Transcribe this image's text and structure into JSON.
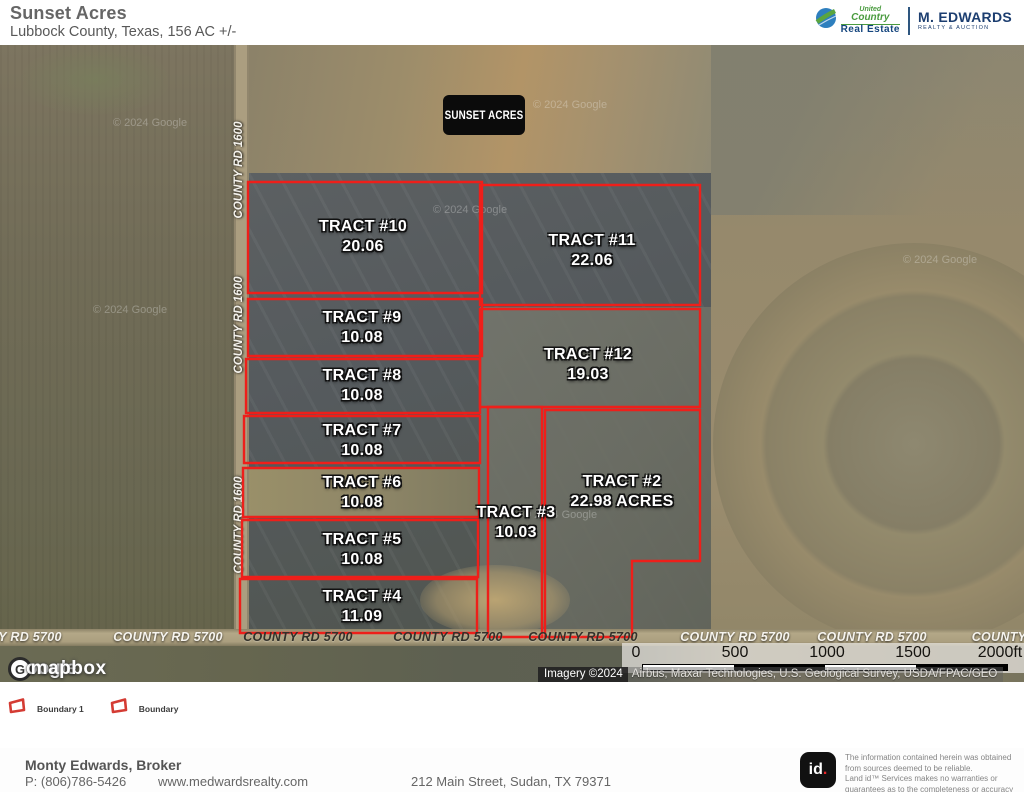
{
  "header": {
    "title": "Sunset Acres",
    "subtitle": "Lubbock County, Texas, 156 AC +/-",
    "brand": {
      "uc_top": "United",
      "uc_mid": "Country",
      "uc_bottom": "Real Estate",
      "agency_name": "M. EDWARDS",
      "agency_tagline": "REALTY & AUCTION"
    }
  },
  "map": {
    "badge": "SUNSET ACRES",
    "boundary_color": "#ee1f1a",
    "tracts": [
      {
        "id": "tract-10",
        "name": "TRACT #10",
        "acres": "20.06",
        "points": "248,137 482,137 482,248 248,248",
        "label": {
          "x": 363,
          "y": 192
        }
      },
      {
        "id": "tract-11",
        "name": "TRACT #11",
        "acres": "22.06",
        "points": "480,140 700,140 700,260 480,260",
        "label": {
          "x": 592,
          "y": 206
        }
      },
      {
        "id": "tract-9",
        "name": "TRACT #9",
        "acres": "10.08",
        "points": "248,254 482,254 482,311 248,311",
        "label": {
          "x": 362,
          "y": 283
        }
      },
      {
        "id": "tract-12",
        "name": "TRACT #12",
        "acres": "19.03",
        "points": "480,264 700,264 700,362 480,362",
        "label": {
          "x": 588,
          "y": 320
        }
      },
      {
        "id": "tract-8",
        "name": "TRACT #8",
        "acres": "10.08",
        "points": "246,314 480,314 480,368 246,368",
        "label": {
          "x": 362,
          "y": 341
        }
      },
      {
        "id": "tract-7",
        "name": "TRACT #7",
        "acres": "10.08",
        "points": "244,371 480,371 480,418 244,418",
        "label": {
          "x": 362,
          "y": 396
        }
      },
      {
        "id": "tract-6",
        "name": "TRACT #6",
        "acres": "10.08",
        "points": "243,423 479,423 479,472 243,472",
        "label": {
          "x": 362,
          "y": 448
        }
      },
      {
        "id": "tract-5",
        "name": "TRACT #5",
        "acres": "10.08",
        "points": "242,475 478,475 478,532 242,532",
        "label": {
          "x": 362,
          "y": 505
        }
      },
      {
        "id": "tract-4",
        "name": "TRACT #4",
        "acres": "11.09",
        "points": "240,534 477,534 477,588 240,588",
        "label": {
          "x": 362,
          "y": 562
        }
      },
      {
        "id": "tract-3",
        "name": "TRACT #3",
        "acres": "10.03",
        "points": "488,362 542,362 542,592 488,592",
        "label": {
          "x": 516,
          "y": 478
        }
      },
      {
        "id": "tract-2",
        "name": "TRACT #2",
        "acres": "22.98 ACRES",
        "points": "545,365 700,365 700,516 632,516 632,592 545,592",
        "label": {
          "x": 622,
          "y": 447
        }
      }
    ],
    "road_labels_vertical": [
      {
        "text": "COUNTY RD 1600",
        "x": 239,
        "y": 125
      },
      {
        "text": "COUNTY RD 1600",
        "x": 239,
        "y": 280
      },
      {
        "text": "COUNTY RD 1600",
        "x": 239,
        "y": 480
      }
    ],
    "road_labels_horizontal": [
      {
        "text": "Y RD 5700",
        "x": 30,
        "y": 592,
        "tone": "light"
      },
      {
        "text": "COUNTY RD 5700",
        "x": 168,
        "y": 592,
        "tone": "light"
      },
      {
        "text": "COUNTY RD 5700",
        "x": 298,
        "y": 592,
        "tone": "dark"
      },
      {
        "text": "COUNTY RD 5700",
        "x": 448,
        "y": 592,
        "tone": "dark"
      },
      {
        "text": "COUNTY RD 5700",
        "x": 583,
        "y": 592,
        "tone": "dark"
      },
      {
        "text": "COUNTY RD 5700",
        "x": 735,
        "y": 592,
        "tone": "light"
      },
      {
        "text": "COUNTY RD 5700",
        "x": 872,
        "y": 592,
        "tone": "light"
      },
      {
        "text": "COUNTY",
        "x": 999,
        "y": 592,
        "tone": "light"
      }
    ],
    "watermark_text": "© 2024 Google",
    "watermark_positions": [
      {
        "x": 150,
        "y": 78
      },
      {
        "x": 470,
        "y": 165
      },
      {
        "x": 130,
        "y": 265
      },
      {
        "x": 560,
        "y": 470
      },
      {
        "x": 940,
        "y": 215
      },
      {
        "x": 570,
        "y": 60
      }
    ],
    "scalebar": {
      "ticks": [
        {
          "label": "0",
          "x": 14
        },
        {
          "label": "500",
          "x": 113
        },
        {
          "label": "1000",
          "x": 205
        },
        {
          "label": "1500",
          "x": 291
        },
        {
          "label": "2000ft",
          "x": 378
        }
      ]
    },
    "attribution": {
      "prefix": "Imagery ©2024",
      "sources": "Airbus, Maxar Technologies, U.S. Geological Survey, USDA/FPAC/GEO"
    },
    "logos": {
      "google": "oogle",
      "google_letter": "G",
      "mapbox": "mapbox"
    }
  },
  "legend": {
    "items": [
      {
        "label": "Boundary 1"
      },
      {
        "label": "Boundary"
      }
    ]
  },
  "footer": {
    "broker": "Monty Edwards, Broker",
    "phone": "P: (806)786-5426",
    "website": "www.medwardsrealty.com",
    "address": "212 Main Street, Sudan, TX 79371",
    "landid_logo": "id",
    "landid_dot": ".",
    "disclaimer_line1": "The information contained herein was obtained from sources deemed to be reliable.",
    "disclaimer_line2": "Land id™ Services makes no warranties or guarantees as to the completeness or accuracy thereof."
  }
}
